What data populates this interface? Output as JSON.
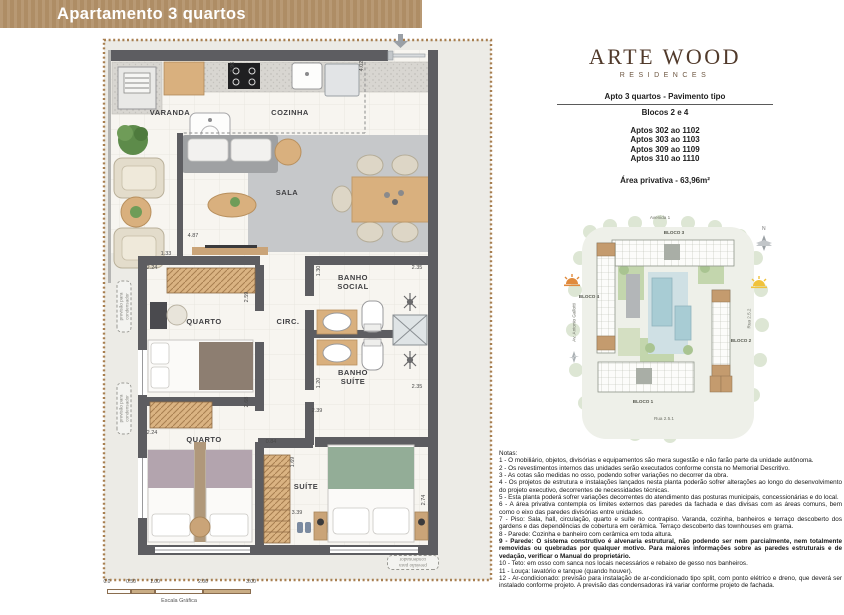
{
  "header": {
    "title": "Apartamento 3 quartos"
  },
  "brand": {
    "name": "ARTE WOOD",
    "tagline": "RESIDENCES"
  },
  "unit_info": {
    "type_line": "Apto 3 quartos - Pavimento tipo",
    "blocks_line": "Blocos 2 e 4",
    "apartments": [
      "Aptos 302 ao 1102",
      "Aptos 303 ao 1103",
      "Aptos 309 ao 1109",
      "Aptos 310 ao 1110"
    ],
    "private_area": "Área privativa - 63,96m²"
  },
  "floorplan": {
    "rooms": {
      "varanda": "VARANDA",
      "cozinha": "COZINHA",
      "sala": "SALA",
      "quarto1": "QUARTO",
      "circ": "CIRC.",
      "banho_social": "BANHO SOCIAL",
      "banho_suite": "BANHO SUÍTE",
      "quarto2": "QUARTO",
      "suite": "SUÍTE"
    },
    "dims": {
      "varanda_top": "3.96",
      "cozinha_top": "4.02",
      "sala_w": "4.87",
      "varanda_w": "1.33",
      "quarto1_w": "2.24",
      "quarto1_h": "2.59",
      "banho_social_w": "1.30",
      "banho_social_h": "2.35",
      "banho_suite_w": "1.20",
      "banho_suite_h": "2.35",
      "quarto2_h": "2.68",
      "suite_hall": "2.39",
      "quarto2_w": "2.24",
      "hall_w": "0.84",
      "closet_w": "1.69",
      "suite_w": "3.39",
      "suite_h": "2.74"
    },
    "condenser_note": "previsão para condensador",
    "scale_bar": {
      "ticks": [
        "0.0",
        "0.50",
        "1.00",
        "2.00",
        "3.00"
      ],
      "label": "Escala Gráfica"
    }
  },
  "siteplan": {
    "streets": {
      "top": "Avenida 1",
      "bottom": "Rua 2.5.1",
      "right": "Rua 2.5.2",
      "left": "Av. Antonio Gallotti"
    },
    "blocks": {
      "b1": "BLOCO 1",
      "b2": "BLOCO 2",
      "b3": "BLOCO 3",
      "b4": "BLOCO 4"
    },
    "north": "N"
  },
  "notes": {
    "title": "Notas:",
    "items": [
      "1 - O mobiliário, objetos, divisórias e equipamentos são mera sugestão e não farão parte da unidade autônoma.",
      "2 - Os revestimentos internos das unidades serão executados conforme consta no Memorial Descritivo.",
      "3 - As cotas são medidas no osso, podendo sofrer variações no decorrer da obra.",
      "4 - Os projetos de estrutura e instalações lançados nesta planta poderão sofrer alterações ao longo do desenvolvimento do projeto executivo, decorrentes de necessidades técnicas.",
      "5 - Esta planta poderá sofrer variações  decorrentes do atendimento das posturas municipais, concessionárias e do local.",
      "6 - A área privativa contempla os  limites externos das  paredes da fachada e das divisas com as áreas comuns, bem como o eixo das paredes divisórias entre unidades.",
      "7 - Piso: Sala, hall, circulação, quarto e suíte  no contrapiso.  Varanda, cozinha, banheiros e terraço  descoberto dos gardens e das dependências de cobertura em cerâmica. Terraço descoberto das townhouses em grama.",
      "8 - Parede: Cozinha e banheiro com cerâmica em toda altura.",
      "9 - Parede:  O sistema  construtivo  é  alvenaria  estrutural,  não  podendo  ser  nem  parcialmente,  nem totalmente removidas  ou  quebradas por qualquer  motivo. Para maiores  informações sobre as paredes estruturais  e  de vedação, verificar o Manual do proprietário.",
      "10 - Teto: em osso com sanca nos locais necessários e rebaixo de gesso nos banheiros.",
      "11 - Louça: lavatório e tanque (quando houver).",
      "12 - Ar-condicionado:  previsão  para  instalação  de  ar-condicionado tipo split, com ponto  elétrico e dreno, que deverá ser instalado conforme projeto. A previsão das condensadoras irá variar conforme projeto de fachada."
    ]
  },
  "colors": {
    "header_bg": "#b39169",
    "logo_brown": "#513a2b",
    "wall_gray": "#5d5d61",
    "wood_tan": "#d9b07e",
    "highlight_unit": "#c49b6e"
  }
}
